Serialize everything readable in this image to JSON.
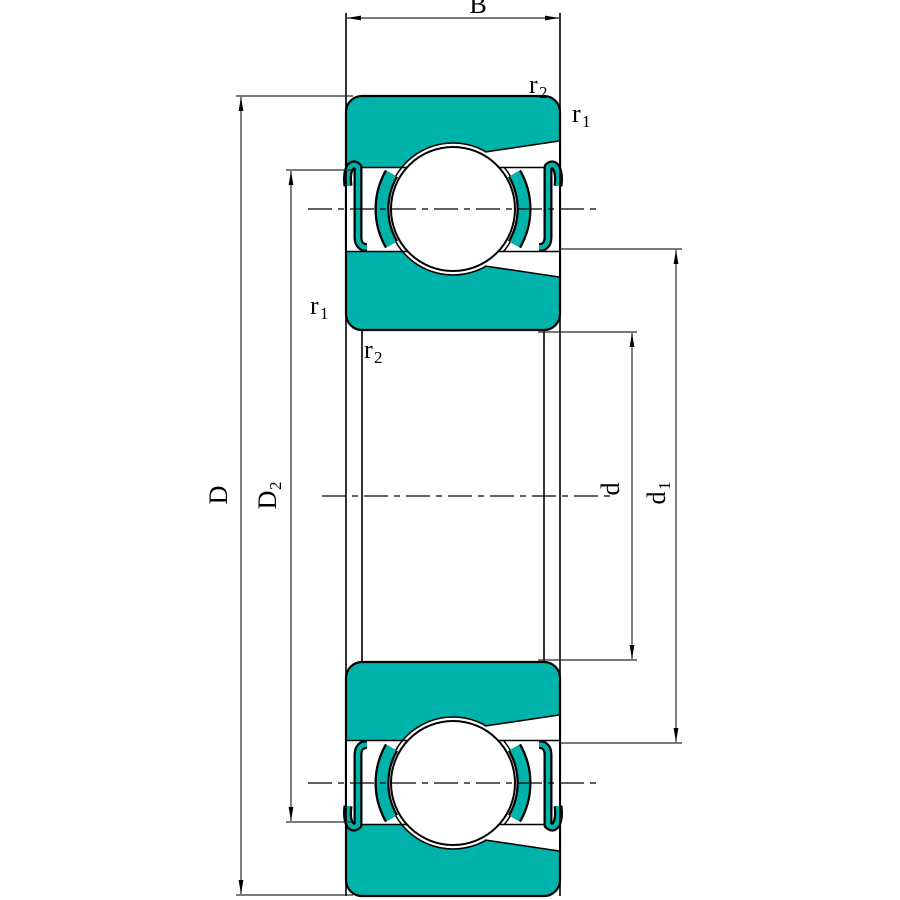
{
  "colors": {
    "ring_fill": "#00b3aa",
    "outline": "#000000",
    "dimension_line": "#2a2a2a",
    "background": "#ffffff"
  },
  "labels": {
    "width": {
      "text": "B"
    },
    "outer_diameter": {
      "text": "D"
    },
    "recess_diameter": {
      "text": "D",
      "sub": "2"
    },
    "bore_diameter": {
      "text": "d"
    },
    "shoulder_diameter": {
      "text": "d",
      "sub": "1"
    },
    "chamfer_r1": {
      "text": "r",
      "sub": "1"
    },
    "chamfer_r2": {
      "text": "r",
      "sub": "2"
    }
  }
}
